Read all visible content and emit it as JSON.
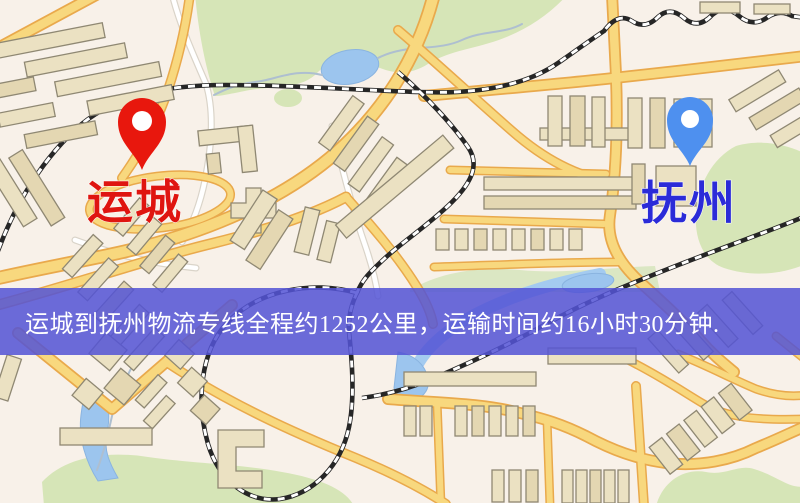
{
  "banner": {
    "text": "运城到抚州物流专线全程约1252公里，运输时间约16小时30分钟.",
    "background": "#5454d5",
    "text_color": "#ffffff"
  },
  "markers": {
    "origin": {
      "label": "运城",
      "label_color": "#df1510",
      "pin_color": "#e8170d"
    },
    "destination": {
      "label": "抚州",
      "label_color": "#2b2bd8",
      "pin_color": "#4e90ef"
    }
  },
  "map": {
    "palette": {
      "background": "#f8f1e9",
      "park": "#d6e5b7",
      "water": "#9cc5ee",
      "road_major_fill": "#f8d87e",
      "road_major_casing": "#e9a94c",
      "road_minor": "#ffffff",
      "building_fill": "#ebe1c2",
      "building_outline": "#8f8873",
      "railway": "#262626"
    }
  }
}
